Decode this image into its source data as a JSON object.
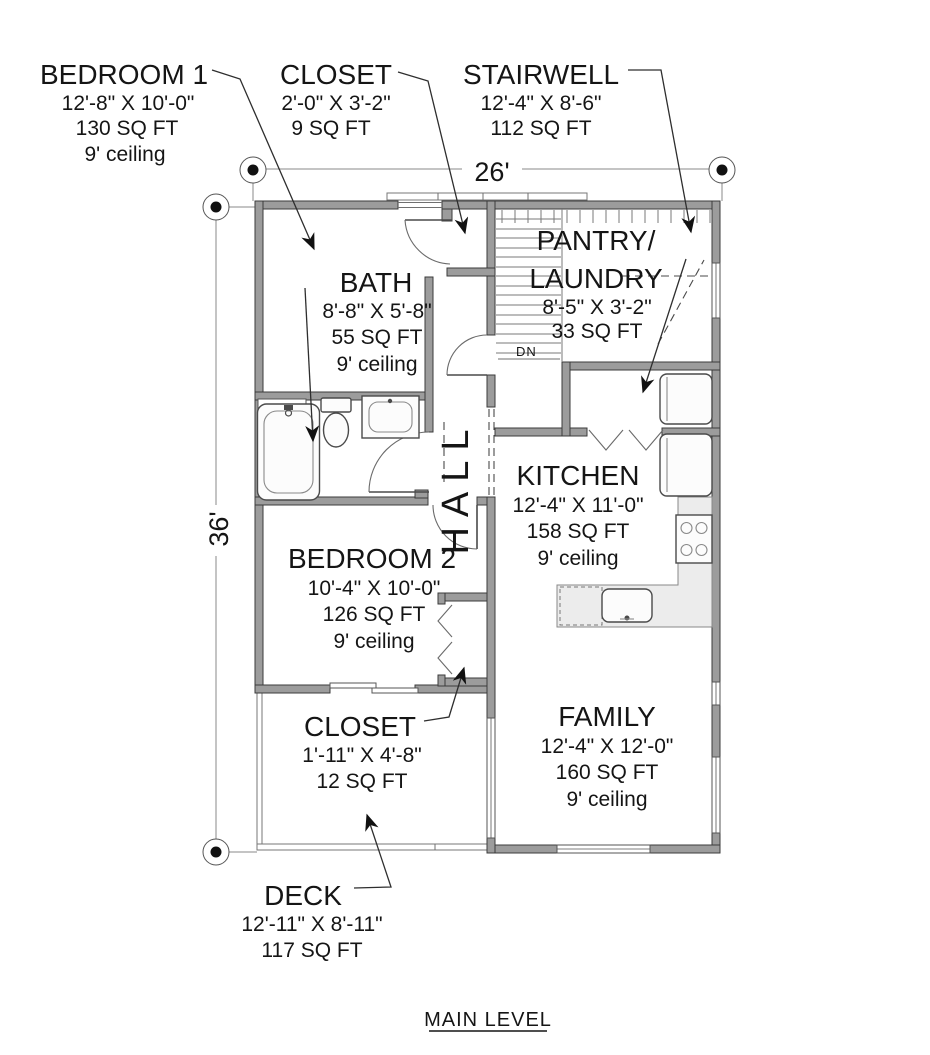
{
  "title": "MAIN LEVEL",
  "dimensions": {
    "width_label": "26'",
    "height_label": "36'"
  },
  "annotations": {
    "down_label": "DN"
  },
  "rooms": {
    "bedroom1": {
      "name": "BEDROOM 1",
      "size": "12'-8\" X 10'-0\"",
      "area": "130 SQ FT",
      "ceiling": "9' ceiling"
    },
    "closet_entry": {
      "name": "CLOSET",
      "size": "2'-0\" X 3'-2\"",
      "area": "9 SQ FT"
    },
    "stairwell": {
      "name": "STAIRWELL",
      "size": "12'-4\" X 8'-6\"",
      "area": "112 SQ FT"
    },
    "bath": {
      "name": "BATH",
      "size": "8'-8\" X 5'-8\"",
      "area": "55 SQ FT",
      "ceiling": "9' ceiling"
    },
    "pantry": {
      "name_line1": "PANTRY/",
      "name_line2": "LAUNDRY",
      "size": "8'-5\" X 3'-2\"",
      "area": "33 SQ FT"
    },
    "hall": {
      "name": "HALL"
    },
    "kitchen": {
      "name": "KITCHEN",
      "size": "12'-4\" X 11'-0\"",
      "area": "158 SQ FT",
      "ceiling": "9' ceiling"
    },
    "bedroom2": {
      "name": "BEDROOM 2",
      "size": "10'-4\" X 10'-0\"",
      "area": "126 SQ FT",
      "ceiling": "9' ceiling"
    },
    "closet2": {
      "name": "CLOSET",
      "size": "1'-11\" X 4'-8\"",
      "area": "12 SQ FT"
    },
    "family": {
      "name": "FAMILY",
      "size": "12'-4\" X 12'-0\"",
      "area": "160 SQ FT",
      "ceiling": "9' ceiling"
    },
    "deck": {
      "name": "DECK",
      "size": "12'-11\" X 8'-11\"",
      "area": "117 SQ FT"
    }
  },
  "colors": {
    "wall_fill": "#9c9c9c",
    "wall_outline": "#3b3b3b",
    "line": "#151515",
    "counter_fill": "#ececec",
    "background": "#ffffff"
  }
}
